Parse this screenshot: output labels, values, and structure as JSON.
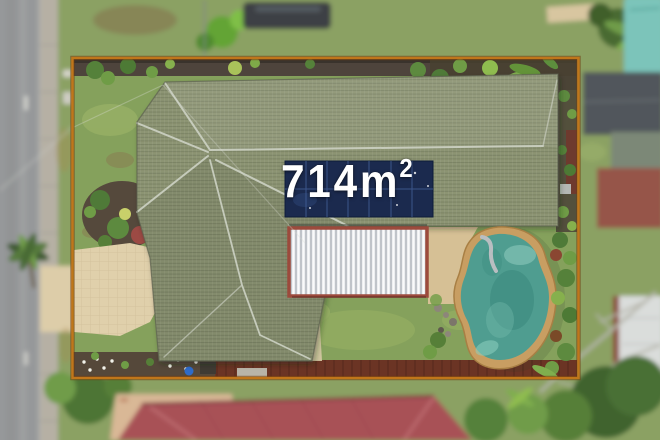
{
  "photo": {
    "area_label": {
      "text": "714m",
      "superscript": "2"
    }
  },
  "colors": {
    "boundary": "#c0761a",
    "boundary_shadow": "#6f3a0e",
    "roof": "#8c9473",
    "ridge": "#cdd2c4",
    "solar": "#1b2a4e",
    "pergola": "#eceef0",
    "pergola_frame": "#9c4a3c",
    "pool_coping": "#c89e62",
    "pool_water": "#4f9d90",
    "paving": "#d6c095",
    "driveway": "#e0d0ab",
    "lawn": "#85a15c",
    "road": "#96989a",
    "footpath": "#b6b0a4",
    "soil": "#55483a",
    "rear_path": "#6b3424",
    "neighbor_roof": "#a85156",
    "label_text": "#ffffff"
  }
}
